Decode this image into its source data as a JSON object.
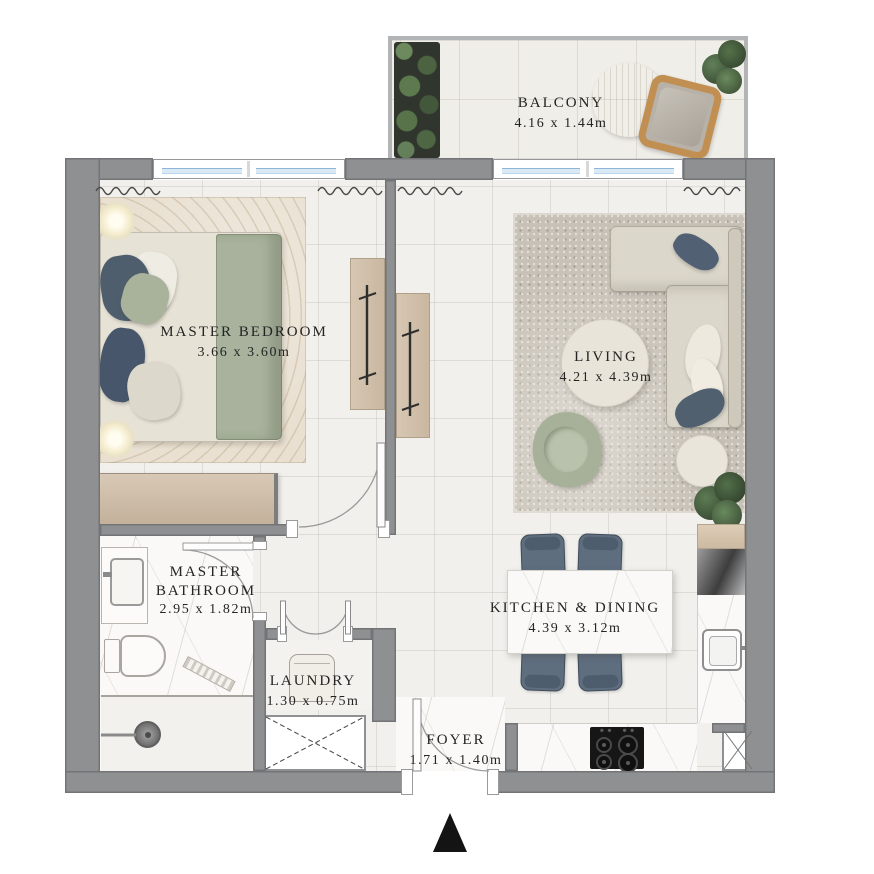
{
  "plan": {
    "type": "apartment-floor-plan",
    "rooms": [
      {
        "id": "balcony",
        "name": "BALCONY",
        "dims": "4.16 x 1.44m"
      },
      {
        "id": "master-bedroom",
        "name": "MASTER BEDROOM",
        "dims": "3.66 x 3.60m"
      },
      {
        "id": "living",
        "name": "LIVING",
        "dims": "4.21 x 4.39m"
      },
      {
        "id": "master-bathroom",
        "name": "MASTER BATHROOM",
        "dims": "2.95 x 1.82m"
      },
      {
        "id": "laundry",
        "name": "LAUNDRY",
        "dims": "1.30 x 0.75m"
      },
      {
        "id": "foyer",
        "name": "FOYER",
        "dims": "1.71 x 1.40m"
      },
      {
        "id": "kitchen-dining",
        "name": "KITCHEN & DINING",
        "dims": "4.39 x 3.12m"
      }
    ],
    "icons": [
      "north-arrow",
      "curtain-squiggle",
      "door-swing",
      "shaft-cross"
    ],
    "colors": {
      "wall": "#8e9092",
      "floor_tile": "#f1f0ec",
      "marble": "#faf9f7",
      "bedroom_rug": "#e9e0d1",
      "living_rug": "#c7c1b7",
      "sofa": "#dcd7cb",
      "accent_pillow_navy": "#51606f",
      "sage_green": "#a9b29b",
      "wood": "#d2c0ab",
      "dining_chair": "#5e6e7f",
      "plant_green": "#4f6a4a",
      "window_glass": "#aecde4",
      "north_arrow": "#141414"
    }
  }
}
